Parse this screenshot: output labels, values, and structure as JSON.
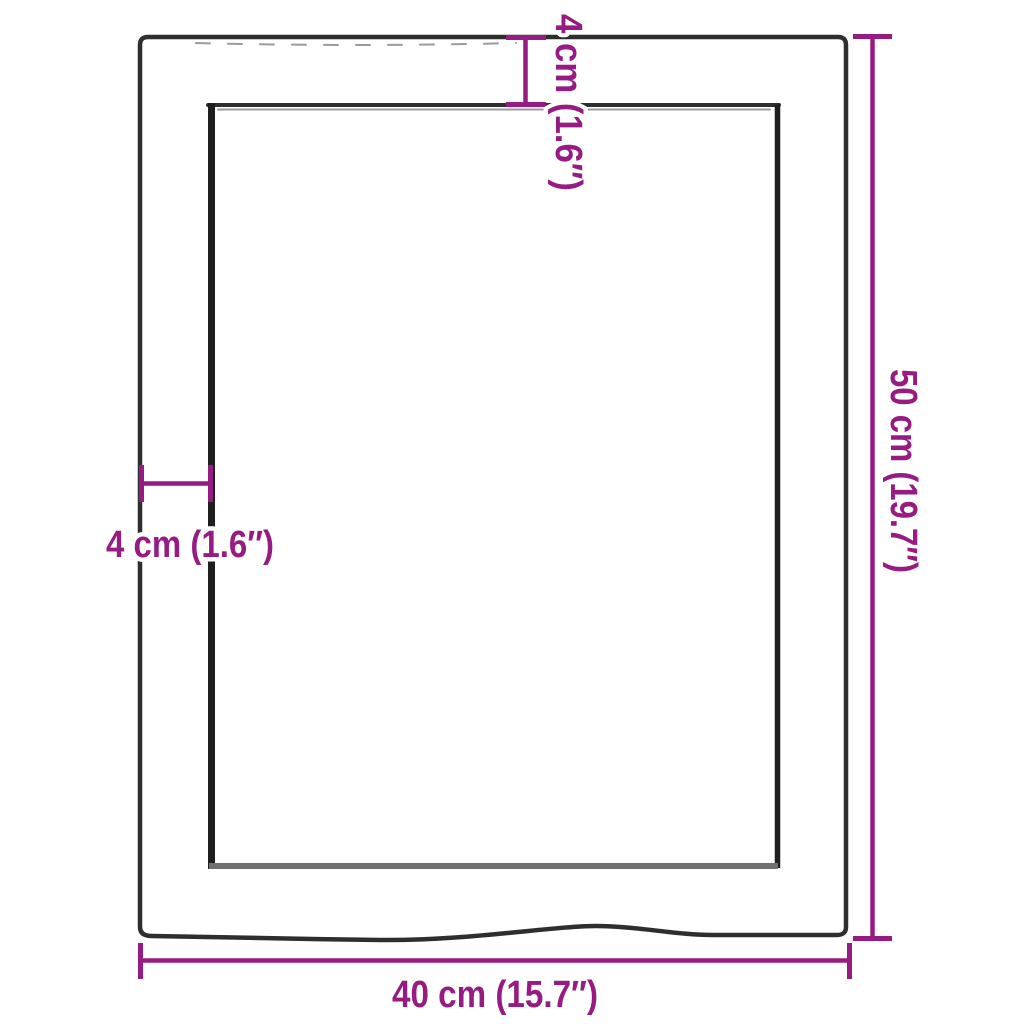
{
  "diagram": {
    "kind": "product-dimension-diagram",
    "background": "#ffffff",
    "colors": {
      "dimension_accent": "#961b82",
      "outline_dark": "#2e2e2e",
      "shading_gray": "#9b9b9b",
      "label_halo": "#ffffff"
    },
    "labels": {
      "width": "40 cm (15.7″)",
      "height": "50 cm (19.7″)",
      "top_border": "4 cm (1.6″)",
      "left_border": "4 cm (1.6″)"
    }
  }
}
